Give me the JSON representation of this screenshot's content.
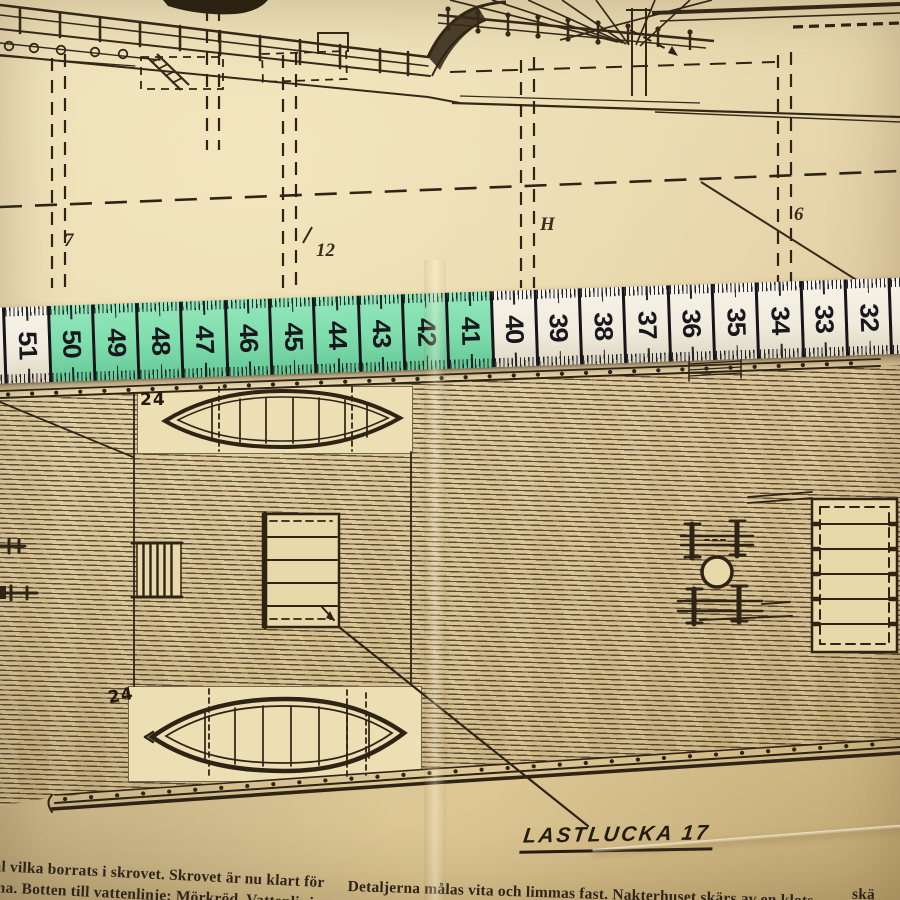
{
  "scene": {
    "description": "Photograph of a vintage ship model plan (profile and deck view) with a sewing tape measure laid across the paper"
  },
  "tape_measure": {
    "cells": [
      {
        "label": "",
        "color": "white"
      },
      {
        "label": "51",
        "color": "white"
      },
      {
        "label": "50",
        "color": "green"
      },
      {
        "label": "49",
        "color": "green"
      },
      {
        "label": "48",
        "color": "green"
      },
      {
        "label": "47",
        "color": "green"
      },
      {
        "label": "46",
        "color": "green"
      },
      {
        "label": "45",
        "color": "green"
      },
      {
        "label": "44",
        "color": "green"
      },
      {
        "label": "43",
        "color": "green"
      },
      {
        "label": "42",
        "color": "green"
      },
      {
        "label": "41",
        "color": "green"
      },
      {
        "label": "40",
        "color": "white"
      },
      {
        "label": "39",
        "color": "white"
      },
      {
        "label": "38",
        "color": "white"
      },
      {
        "label": "37",
        "color": "white"
      },
      {
        "label": "36",
        "color": "white"
      },
      {
        "label": "35",
        "color": "white"
      },
      {
        "label": "34",
        "color": "white"
      },
      {
        "label": "33",
        "color": "white"
      },
      {
        "label": "32",
        "color": "white"
      },
      {
        "label": "31",
        "color": "white"
      },
      {
        "label": "30",
        "color": "purple"
      }
    ],
    "colors": {
      "green": "#7edcab",
      "white": "#f4f0e5",
      "purple": "#ab86ba",
      "ink": "#1b1b22"
    }
  },
  "profile_drawing": {
    "station_labels": [
      {
        "text": "7"
      },
      {
        "text": "12"
      },
      {
        "text": "H"
      },
      {
        "text": "6"
      }
    ]
  },
  "deck_plan": {
    "boat_labels": [
      "24",
      "24"
    ],
    "hatch_caption": "LASTLUCKA 17"
  },
  "captions": {
    "left_lines": [
      "ål vilka borrats i skrovet. Skrovet är nu klart för",
      "ma. Botten till vattenlinje: Mörkröd. Vattenlinj"
    ],
    "right_line": "Detaljerna målas vita och limmas fast. Nakterhuset skärs av en klots",
    "right_fragment": "skä"
  }
}
